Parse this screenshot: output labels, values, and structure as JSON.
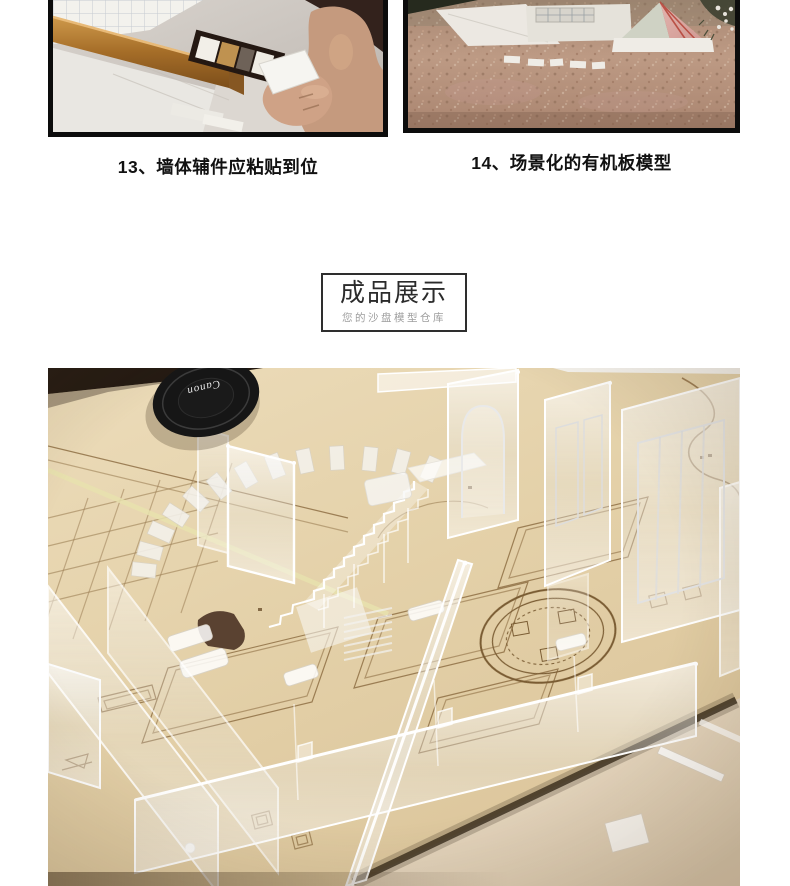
{
  "steps": [
    {
      "caption": "13、墙体辅件应粘贴到位"
    },
    {
      "caption": "14、场景化的有机板模型"
    }
  ],
  "showcase": {
    "title": "成品展示",
    "subtitle": "您的沙盘模型仓库"
  },
  "main_photo": {
    "lens_cap_brand": "Canon"
  },
  "colors": {
    "caption_text": "#111111",
    "frame_border": "#0c0c0c",
    "box_border": "#2e2e2e",
    "subtitle_text": "#9e9e9e",
    "wood_board": "#e6d4ad",
    "desk_surface": "#e7d9c3",
    "etch_line": "#8a6a3f",
    "lens_cap": "#161616"
  }
}
